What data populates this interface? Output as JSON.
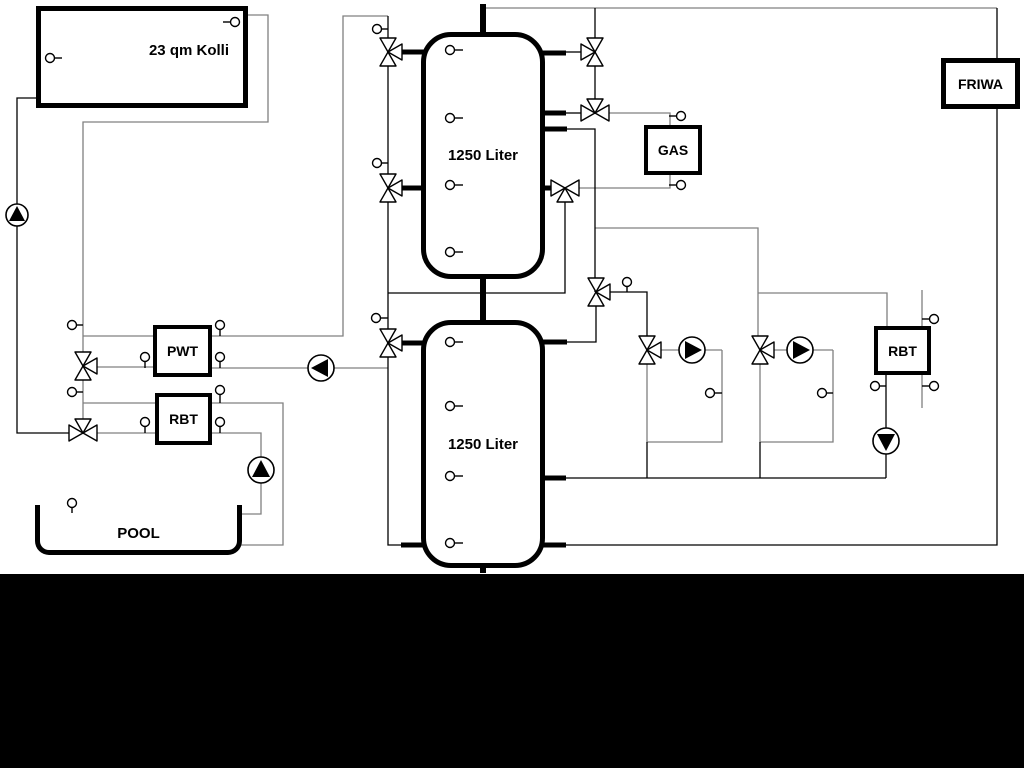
{
  "diagram": {
    "title_note": "hydraulic heating scheme",
    "labels": {
      "collector": "23 qm Kolli",
      "tank1": "1250 Liter",
      "tank2": "1250 Liter",
      "gas": "GAS",
      "friwa": "FRIWA",
      "pwt": "PWT",
      "rbt_left": "RBT",
      "rbt_right": "RBT",
      "pool": "POOL"
    },
    "colors": {
      "background": "#ffffff",
      "line_black": "#000000",
      "line_gray": "#808080",
      "bottom_bar": "#000000"
    },
    "icons": [
      "three-way-valve-icon",
      "pump-icon",
      "temperature-sensor-icon"
    ]
  }
}
